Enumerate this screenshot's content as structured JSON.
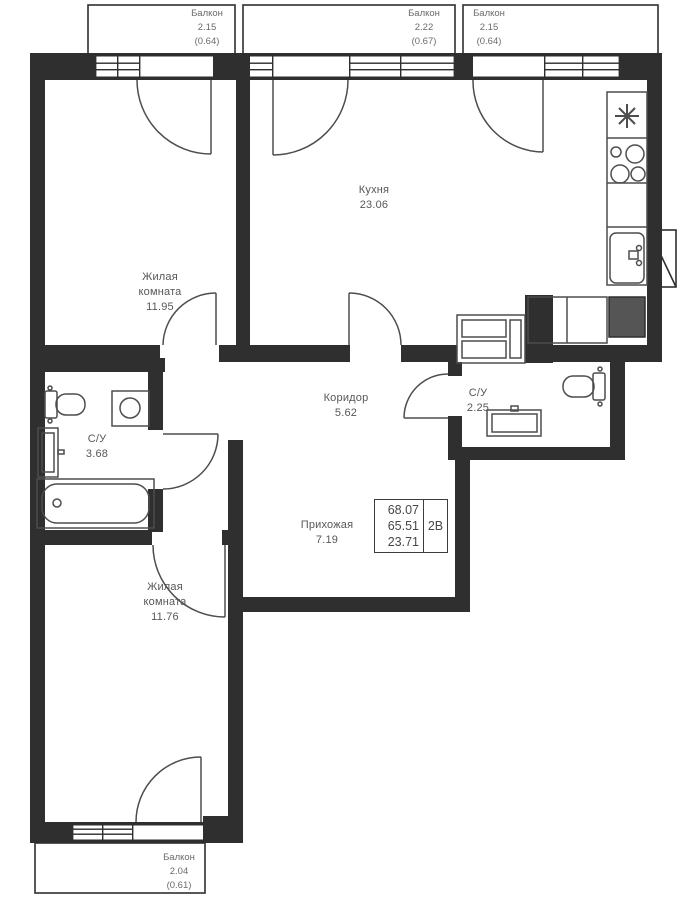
{
  "plan_title": "2-room apartment floor plan",
  "balconies": {
    "b1": {
      "name": "Балкон",
      "area": "2.15",
      "coef": "(0.64)"
    },
    "b2": {
      "name": "Балкон",
      "area": "2.22",
      "coef": "(0.67)"
    },
    "b3": {
      "name": "Балкон",
      "area": "2.15",
      "coef": "(0.64)"
    },
    "b4": {
      "name": "Балкон",
      "area": "2.04",
      "coef": "(0.61)"
    }
  },
  "rooms": {
    "kitchen": {
      "name": "Кухня",
      "area": "23.06"
    },
    "living1": {
      "name1": "Жилая",
      "name2": "комната",
      "area": "11.95"
    },
    "living2": {
      "name1": "Жилая",
      "name2": "комната",
      "area": "11.76"
    },
    "corridor": {
      "name": "Коридор",
      "area": "5.62"
    },
    "bath_big": {
      "name": "С/У",
      "area": "3.68"
    },
    "bath_small": {
      "name": "С/У",
      "area": "2.25"
    },
    "hallway": {
      "name": "Прихожая",
      "area": "7.19"
    }
  },
  "info_box": {
    "area_total": "68.07",
    "area_living": "65.51",
    "area_rooms": "23.71",
    "layout_type": "2В"
  },
  "colors": {
    "wall": "#2f2f2f",
    "fixture_line": "#4d4d4d",
    "room_text": "#575757",
    "balcony_text": "#6b6b6b",
    "filled_unit": "#555555"
  }
}
